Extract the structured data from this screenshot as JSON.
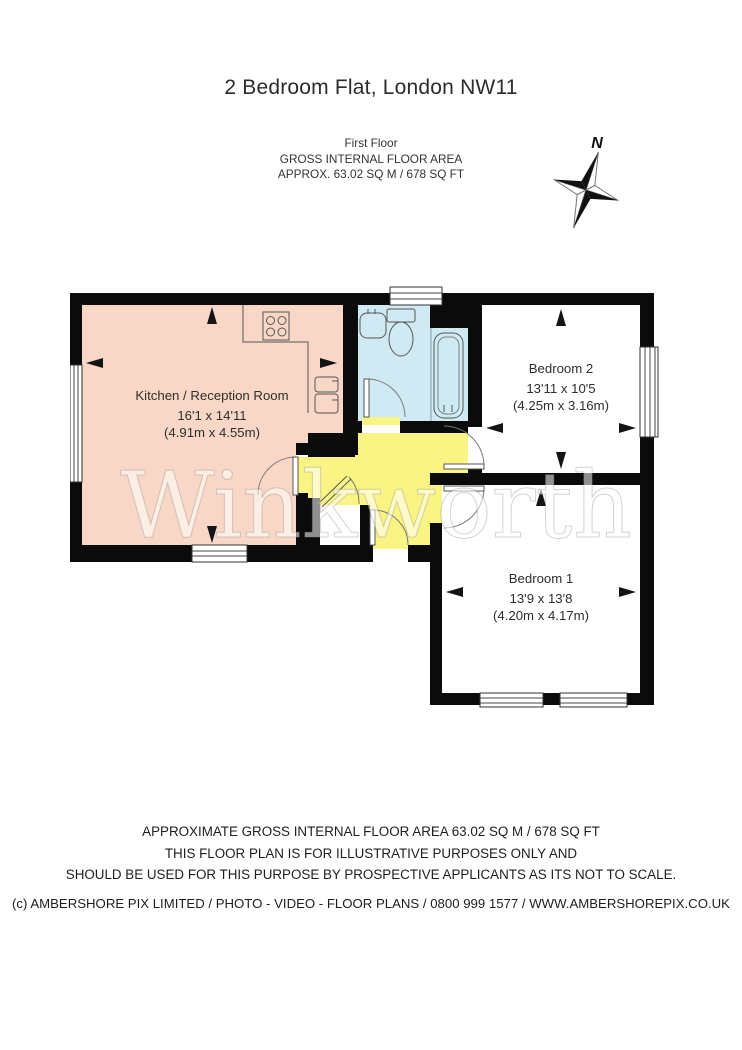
{
  "title": "2 Bedroom Flat, London NW11",
  "header": {
    "line1": "First Floor",
    "line2": "GROSS INTERNAL FLOOR AREA",
    "line3": "APPROX. 63.02 SQ M / 678 SQ FT"
  },
  "compass": {
    "label": "N"
  },
  "watermark": "Winkworth",
  "rooms": {
    "kitchen": {
      "name": "Kitchen / Reception Room",
      "imperial": "16'1 x 14'11",
      "metric": "(4.91m x 4.55m)"
    },
    "bedroom2": {
      "name": "Bedroom 2",
      "imperial": "13'11 x 10'5",
      "metric": "(4.25m x 3.16m)"
    },
    "bedroom1": {
      "name": "Bedroom 1",
      "imperial": "13'9 x 13'8",
      "metric": "(4.20m x 4.17m)"
    }
  },
  "footer": {
    "line1": "APPROXIMATE GROSS INTERNAL FLOOR AREA 63.02 SQ M / 678 SQ FT",
    "line2": "THIS FLOOR PLAN IS FOR ILLUSTRATIVE PURPOSES ONLY AND",
    "line3": "SHOULD BE USED FOR THIS PURPOSE BY PROSPECTIVE APPLICANTS AS ITS NOT TO SCALE."
  },
  "copyright": "(c) AMBERSHORE PIX LIMITED / PHOTO - VIDEO - FLOOR PLANS / 0800 999 1577 / WWW.AMBERSHOREPIX.CO.UK",
  "colors": {
    "kitchen": "#f9d7c6",
    "bathroom": "#cfeaf3",
    "hallway": "#faf485",
    "room_white": "#ffffff",
    "wall": "#0b0b0b"
  }
}
